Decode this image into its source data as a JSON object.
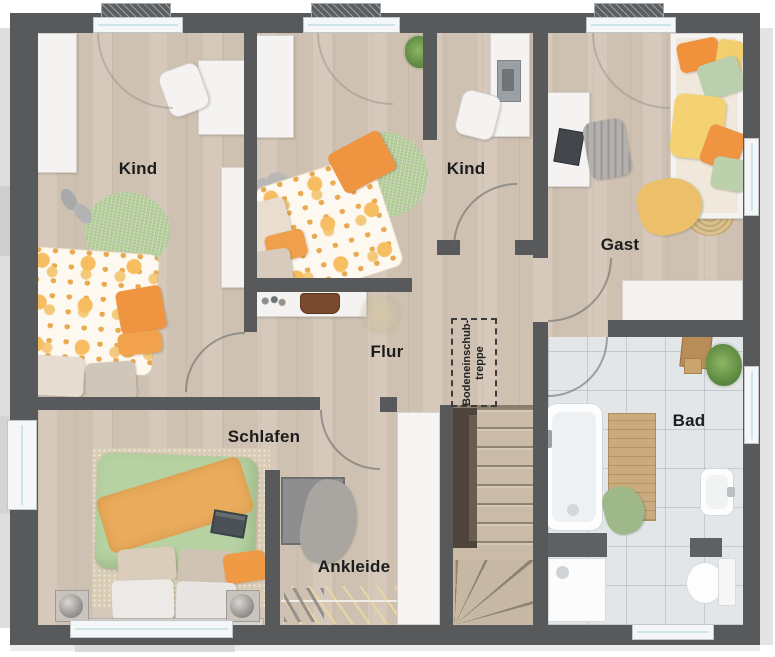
{
  "rooms": {
    "kind1": {
      "label": "Kind"
    },
    "kind2": {
      "label": "Kind"
    },
    "gast": {
      "label": "Gast"
    },
    "flur": {
      "label": "Flur"
    },
    "schlafen": {
      "label": "Schlafen"
    },
    "ankleide": {
      "label": "Ankleide"
    },
    "bad": {
      "label": "Bad"
    }
  },
  "annotations": {
    "loft_ladder": {
      "line1": "Bodeneinschub-",
      "line2": "treppe"
    }
  },
  "palette": {
    "wall": "#57595b",
    "wood_floor": "#d3c6b7",
    "bath_tile": "#e3e6e9",
    "accent_orange": "#ef9440",
    "accent_yellow": "#f2cf6e",
    "accent_green": "#b9cfa0",
    "label_text": "#1c1c1c"
  }
}
